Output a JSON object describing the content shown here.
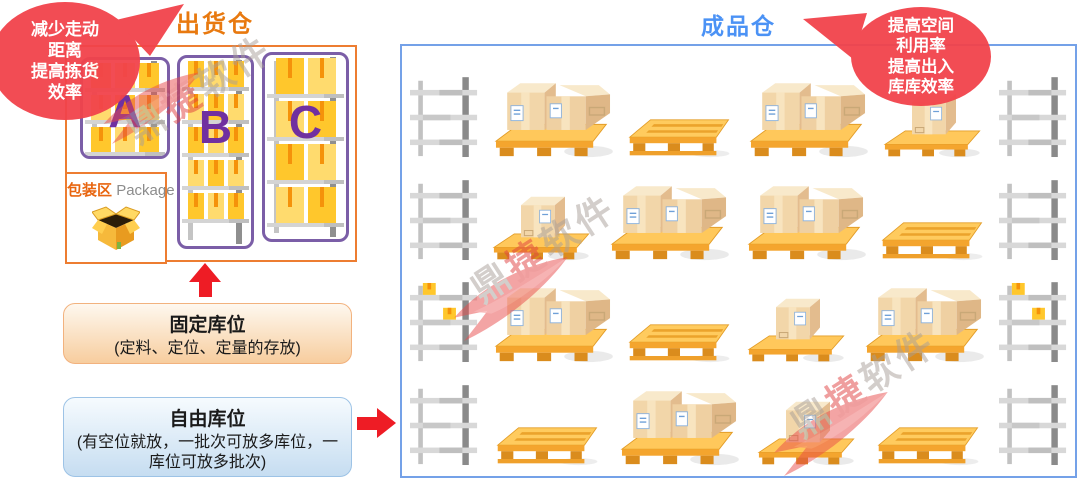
{
  "shipping": {
    "title": "出货仓",
    "zones": [
      {
        "label": "A",
        "rows": 3,
        "cols": 3
      },
      {
        "label": "B",
        "rows": 5,
        "cols": 3
      },
      {
        "label": "C",
        "rows": 4,
        "cols": 2
      }
    ],
    "package_area": {
      "label_cn": "包装区",
      "label_en": "Package"
    }
  },
  "finished": {
    "title": "成品仓",
    "grid": [
      [
        "rack",
        "bigbox",
        "pallet",
        "bigbox",
        "singlebox",
        "rack"
      ],
      [
        "rack",
        "singlebox",
        "bigbox",
        "bigbox",
        "pallet",
        "rack"
      ],
      [
        "rackBoxes",
        "bigbox",
        "pallet",
        "singlebox",
        "bigbox",
        "rackBoxes"
      ],
      [
        "rack",
        "pallet",
        "bigbox",
        "singlebox",
        "pallet",
        "rack"
      ]
    ]
  },
  "callouts": {
    "left": {
      "lines": [
        "减少走动",
        "距离",
        "提高拣货",
        "效率"
      ]
    },
    "right": {
      "lines": [
        "提高空间",
        "利用率",
        "提高出入",
        "库库效率"
      ]
    }
  },
  "cards": {
    "fixed": {
      "title": "固定库位",
      "desc": "(定料、定位、定量的存放)"
    },
    "free": {
      "title": "自由库位",
      "desc": "(有空位就放，一批次可放多库位，一库位可放多批次)"
    }
  },
  "watermark": {
    "parts": [
      "鼎",
      "捷",
      "软件"
    ]
  },
  "colors": {
    "panel_orange": "#ED7D31",
    "title_orange": "#E8790F",
    "zone_purple": "#7B5EA7",
    "zone_letter_purple": "#7030A0",
    "box_yellow": "#FFC72C",
    "box_yellow_light": "#FFDB6E",
    "box_stripe_orange": "#F5920A",
    "panel_blue": "#74A1E8",
    "title_blue": "#4B92F5",
    "bubble_red": "#F2434B",
    "arrow_red": "#EE1C25",
    "card_fixed_border": "#F2B27E",
    "card_free_border": "#9DC3E6",
    "watermark_gray": "#A89F98",
    "watermark_red": "#E04040"
  }
}
